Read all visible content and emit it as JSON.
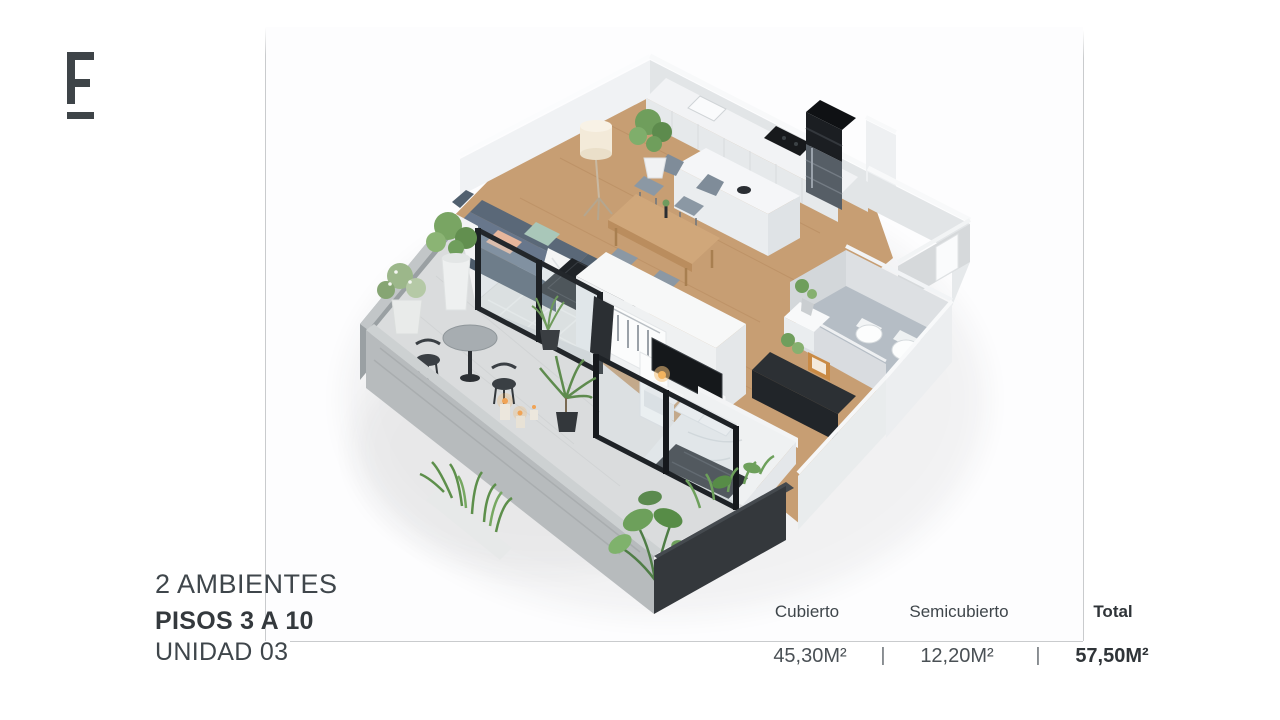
{
  "logo": {
    "letter": "F"
  },
  "unit_info": {
    "rooms_label": "2 AMBIENTES",
    "floors_label": "PISOS 3 A 10",
    "unit_label": "UNIDAD 03"
  },
  "area_table": {
    "separator": "|",
    "columns": [
      {
        "label": "Cubierto",
        "value": "45,30M²",
        "bold": false
      },
      {
        "label": "Semicubierto",
        "value": "12,20M²",
        "bold": false
      },
      {
        "label": "Total",
        "value": "57,50M²",
        "bold": true
      }
    ]
  },
  "palette": {
    "text_primary": "#3f464b",
    "line_gray": "#c9cbcd",
    "wood": "#c79e73",
    "wall_light": "#eceef0",
    "wall_mid": "#e0e3e5",
    "concrete": "#b2b6b8",
    "frame_black": "#202428",
    "sofa_blue_gray": "#5d6c7c",
    "cushion_mint": "#a9c7b9",
    "cushion_peach": "#e7b69c",
    "plant_green": "#71a05e",
    "bath_floor": "#b5bdc5",
    "candle_glow": "#f0a355"
  }
}
